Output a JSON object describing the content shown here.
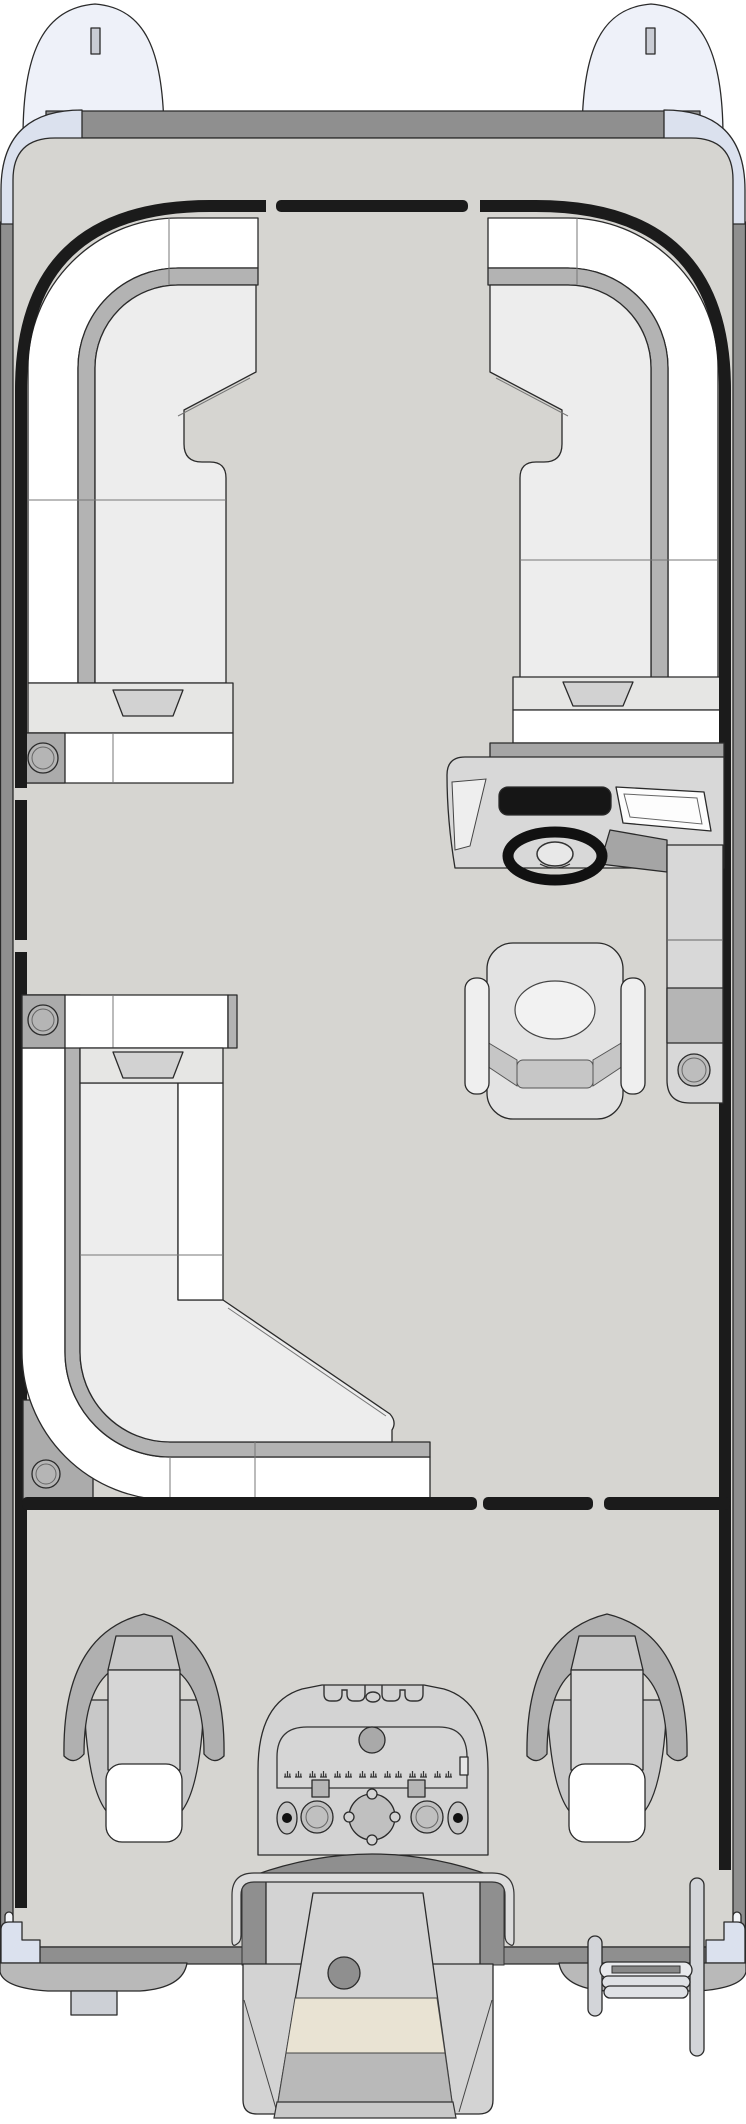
{
  "diagram": {
    "type": "pontoon-boat-floorplan",
    "view": "top-down",
    "orientation": "bow-at-top"
  },
  "colors": {
    "outline": "#2a2a2a",
    "floor": "#d6d5d1",
    "tube": "#8f8f8f",
    "tubeEnd": "#b9b9b9",
    "nose": "#eef1f9",
    "cap": "#dbe1ee",
    "rail": "#1b1b1b",
    "seatWhite": "#ffffff",
    "rim": "#b3b3b3",
    "cushion": "#ededed",
    "platform": "#e6e6e4",
    "stepGray": "#d2d2d2",
    "panelGray": "#ababab",
    "console": "#d8d8d8",
    "consoleDark": "#a5a5a5",
    "screen": "#161616",
    "chair": "#e3e3e3",
    "chairAccent": "#c6c6c6",
    "fishCollar": "#b0b0b0",
    "fishBody": "#c8c8c8",
    "fishInner": "#d6d6d6",
    "motor": "#d3d3d3",
    "motorBeige": "#e9e3d3",
    "motorMid": "#b9b9b9",
    "bracket": "#dcdcdc",
    "ladder": "#d3d5d9"
  },
  "parts": {
    "bow": [
      "nose-cone-port",
      "nose-cone-starboard",
      "cleat-slot-port",
      "cleat-slot-starboard",
      "corner-cap-port",
      "corner-cap-starboard",
      "bow-gate-rail"
    ],
    "seating": [
      "bow-lounge-port",
      "bow-lounge-starboard",
      "midship-lounge-port",
      "captain-chair",
      "fishing-seat-port",
      "fishing-seat-starboard"
    ],
    "helm": [
      "helm-console",
      "dash-screen",
      "windshield",
      "steering-wheel",
      "side-console"
    ],
    "aft": [
      "aft-gate-rails",
      "transom",
      "outboard-motor",
      "motor-bracket",
      "boarding-ladder",
      "skeg"
    ],
    "fixtures": {
      "cup_holders": 4,
      "gates": 4
    }
  }
}
